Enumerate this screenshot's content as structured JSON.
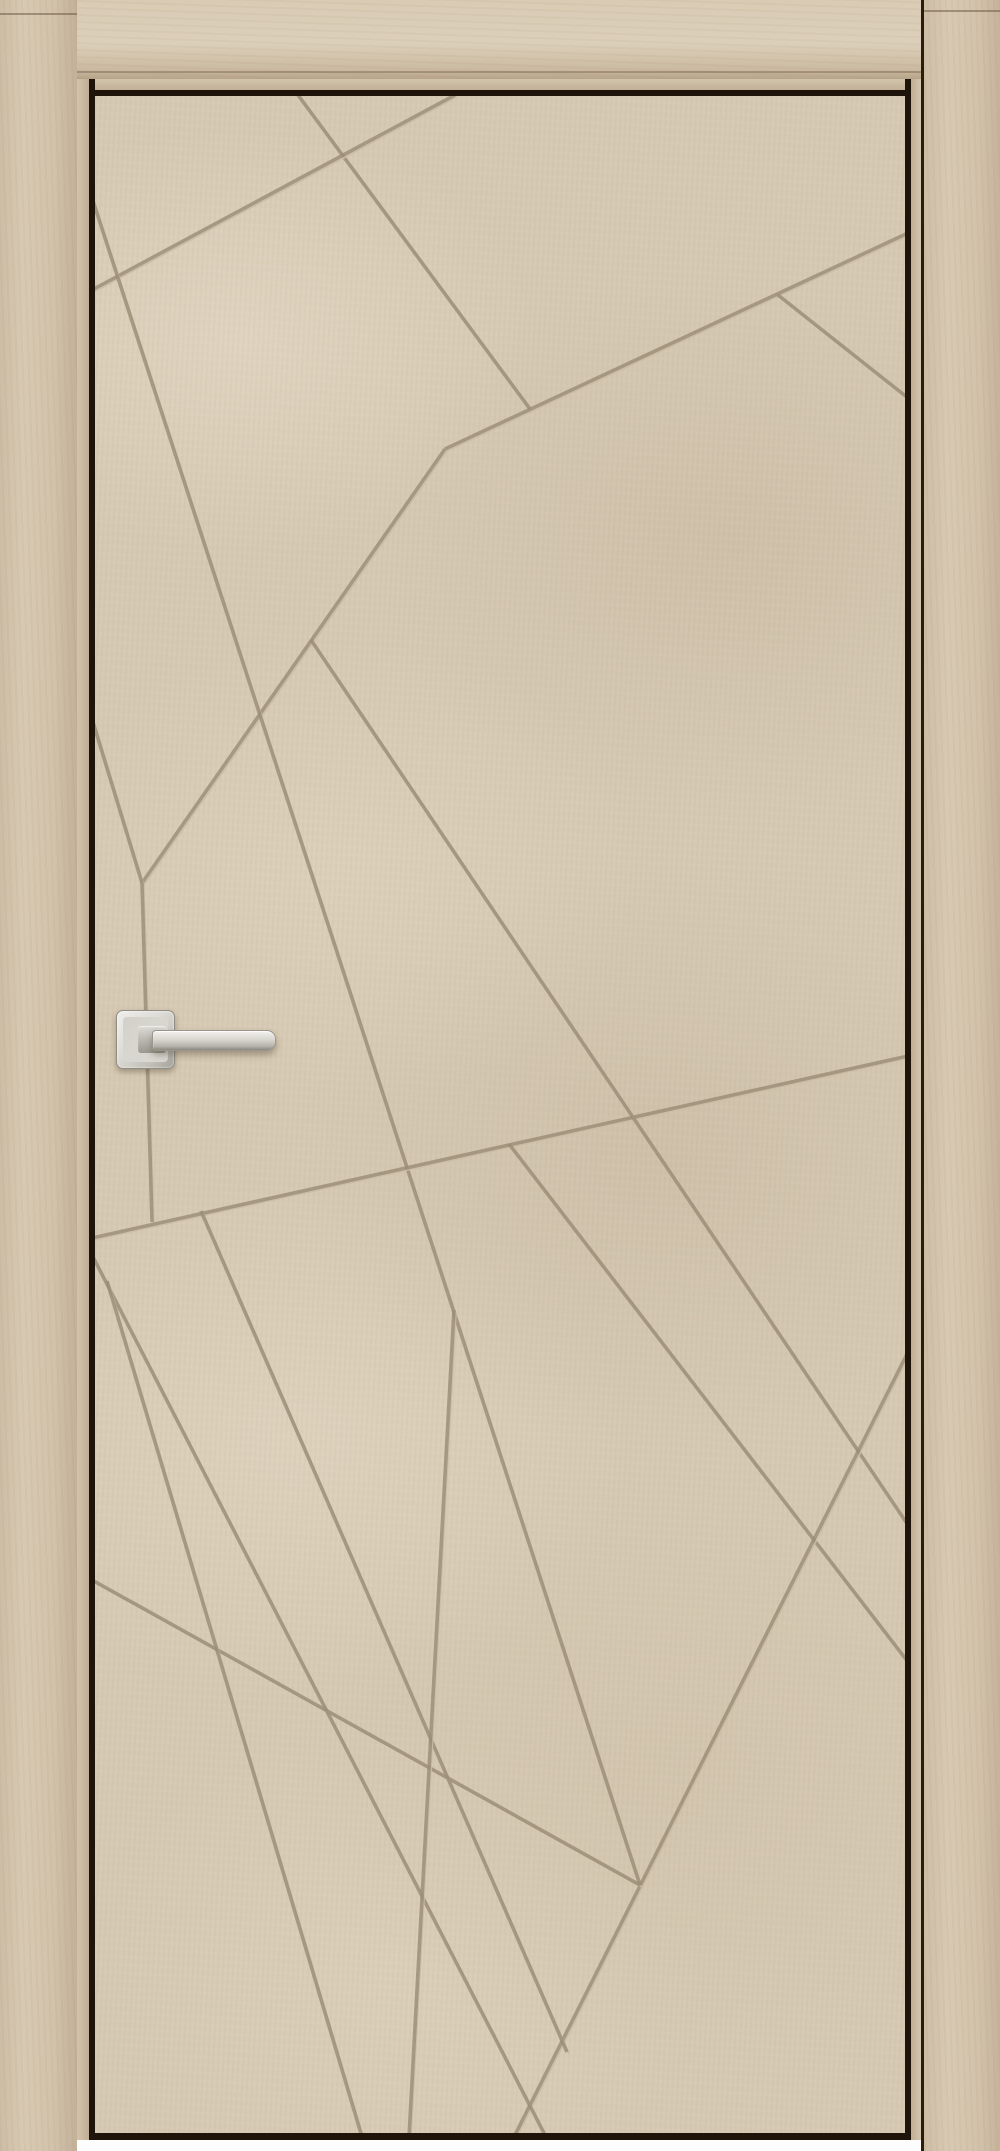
{
  "scene": {
    "subject": "interior door product photo",
    "door_finish": "light beige loft-concrete laminate",
    "pattern_style": "random criss-crossing engraved grooves",
    "frame": "matching beige casing with black shadow gap",
    "handle_style": "square-rose satin nickel lever, left side"
  },
  "colors": {
    "white": "#ffffff",
    "panel_base": "#d6c9b3",
    "panel_light": "#e4d9c3",
    "panel_dark": "#c3b299",
    "casing": "#d5c6af",
    "reveal": "#cbbca3",
    "shadow_gap": "#1f1409",
    "groove_dark": "#9c8d77",
    "groove_light": "#cbbda4",
    "handle_metal_light": "#f0efec",
    "handle_metal_dark": "#8e8c84"
  },
  "layout": {
    "canvas": {
      "w": 1000,
      "h": 2151
    },
    "panel": {
      "x": 95,
      "y": 96,
      "w": 810,
      "h": 2037
    },
    "jamb_left_seam_y": 13,
    "jamb_right_seam_y": 10
  },
  "pattern_segments": [
    [
      298,
      95,
      530,
      409
    ],
    [
      455,
      95,
      92,
      290
    ],
    [
      445,
      449,
      908,
      233
    ],
    [
      778,
      295,
      908,
      398
    ],
    [
      445,
      449,
      142,
      883
    ],
    [
      92,
      198,
      640,
      1885
    ],
    [
      92,
      719,
      142,
      883
    ],
    [
      142,
      883,
      152,
      1222
    ],
    [
      92,
      1238,
      908,
      1056
    ],
    [
      311,
      640,
      908,
      1525
    ],
    [
      509,
      1144,
      908,
      1662
    ],
    [
      908,
      1352,
      514,
      2137
    ],
    [
      92,
      1255,
      546,
      2137
    ],
    [
      201,
      1211,
      567,
      2052
    ],
    [
      92,
      1580,
      640,
      1885
    ],
    [
      107,
      1281,
      362,
      2137
    ],
    [
      454,
      1310,
      409,
      2137
    ]
  ],
  "groove": {
    "width_dark": 3.6,
    "width_light": 1.6,
    "light_offset": 2
  },
  "handle": {
    "rose": {
      "x": 116,
      "y": 1010,
      "w": 57,
      "h": 57
    },
    "neck": {
      "x": 138,
      "y": 1026,
      "w": 28,
      "h": 27
    },
    "lever": {
      "x": 152,
      "y": 1030,
      "w": 122,
      "h": 19
    }
  }
}
